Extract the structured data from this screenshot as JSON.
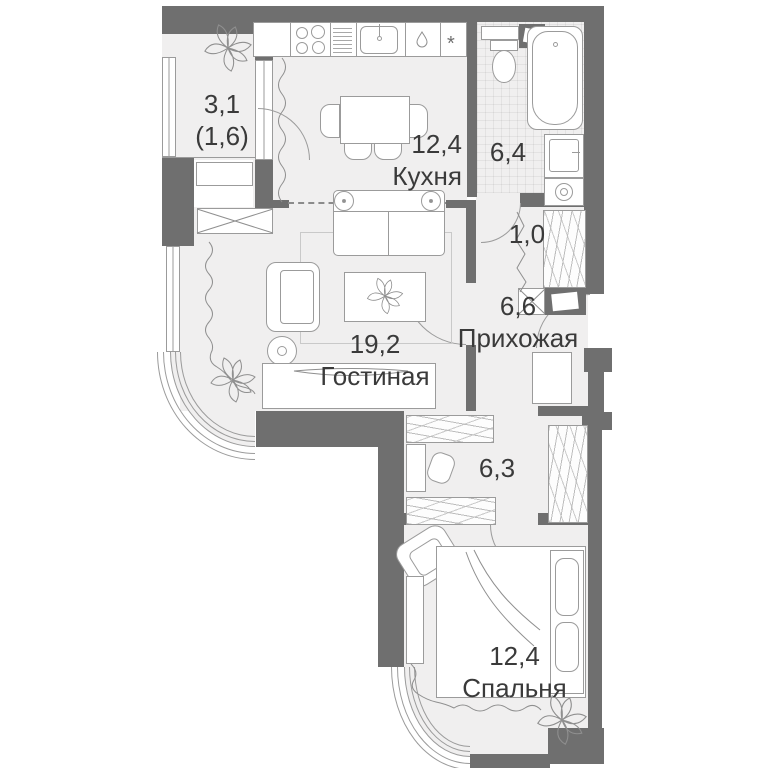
{
  "plan_title": "apartment-floor-plan",
  "colors": {
    "wall": "#6f6f6f",
    "floor": "#f0efef",
    "outline": "#9b9b9b",
    "text": "#3a3a3a",
    "background": "#ffffff"
  },
  "rooms": {
    "balcony": {
      "area": "3,1",
      "area_note": "(1,6)"
    },
    "kitchen": {
      "area": "12,4",
      "name": "Кухня"
    },
    "bathroom": {
      "area": "6,4"
    },
    "closet": {
      "area": "1,0"
    },
    "hallway": {
      "area": "6,6",
      "name": "Прихожая"
    },
    "living": {
      "area": "19,2",
      "name": "Гостиная"
    },
    "corridor": {
      "area": "6,3"
    },
    "bedroom": {
      "area": "12,4",
      "name": "Спальня"
    }
  },
  "symbols": {
    "defrost_asterisk": "*"
  }
}
